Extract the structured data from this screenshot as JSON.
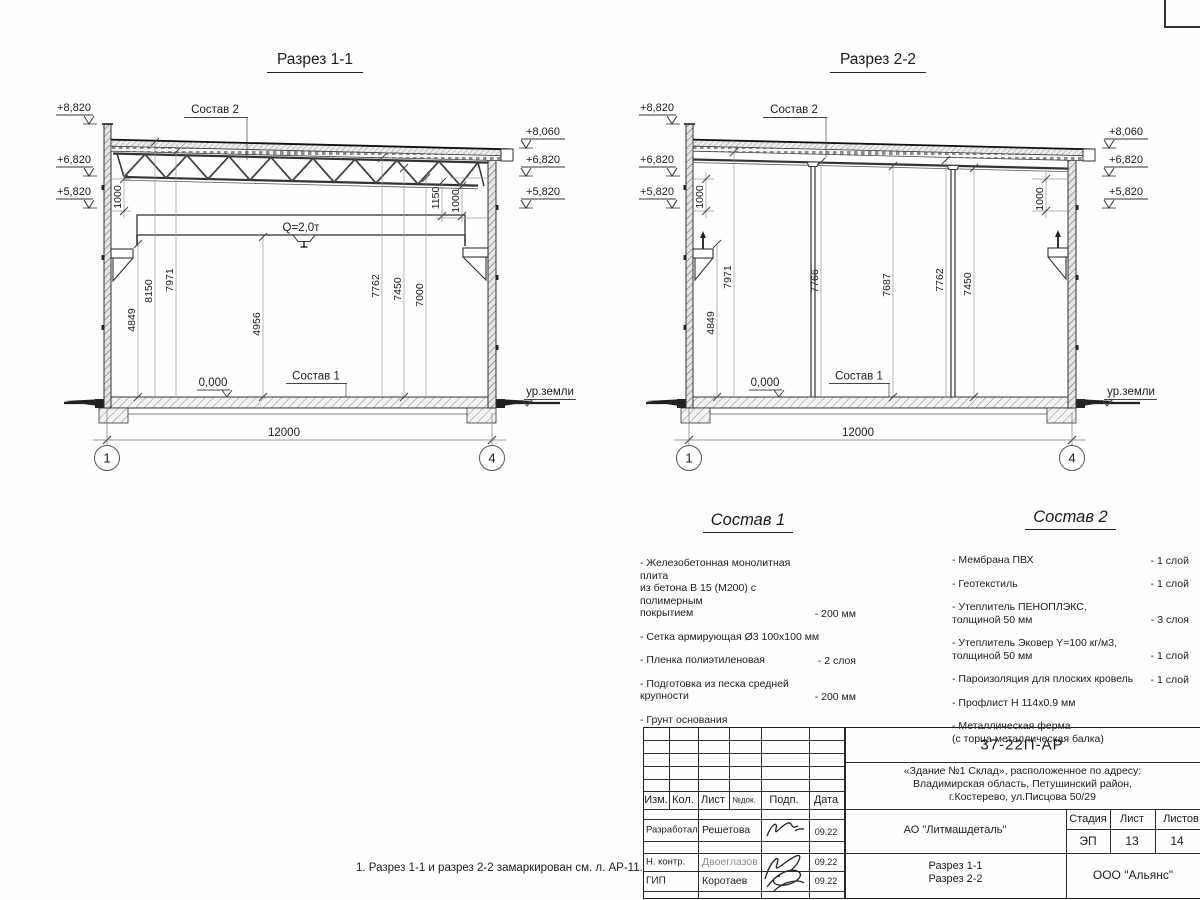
{
  "sheet": {
    "note": "1. Разрез 1-1 и разрез 2-2 замаркирован см. л. АР-11."
  },
  "section1": {
    "title": "Разрез 1-1",
    "labels": {
      "sostav2": "Состав 2",
      "sostav1": "Состав 1",
      "zero": "0,000",
      "ground": "ур.земли",
      "crane": "Q=2,0т"
    },
    "elevations_left": [
      "+8,820",
      "+6,820",
      "+5,820"
    ],
    "elevations_right": [
      "+8,060",
      "+6,820",
      "+5,820"
    ],
    "dims_vertical": [
      "4849",
      "8150",
      "7971",
      "4956",
      "7762",
      "7450",
      "7000"
    ],
    "dims_side": [
      "1000",
      "1150",
      "1000"
    ],
    "span": "12000",
    "axes": {
      "left": "1",
      "right": "4"
    }
  },
  "section2": {
    "title": "Разрез 2-2",
    "labels": {
      "sostav2": "Состав 2",
      "sostav1": "Состав 1",
      "zero": "0,000",
      "ground": "ур.земли"
    },
    "elevations_left": [
      "+8,820",
      "+6,820",
      "+5,820"
    ],
    "elevations_right": [
      "+8,060",
      "+6,820",
      "+5,820"
    ],
    "dims_vertical": [
      "4849",
      "7971",
      "7766",
      "7687",
      "7762",
      "7450"
    ],
    "dims_side": [
      "1000",
      "1000"
    ],
    "span": "12000",
    "axes": {
      "left": "1",
      "right": "4"
    }
  },
  "sostav1_block": {
    "title": "Состав 1",
    "items": [
      {
        "text": "- Железобетонная  монолитная плита\nиз бетона В 15 (М200) с полимерным\nпокрытием",
        "qty": "- 200 мм"
      },
      {
        "text": "- Сетка армирующая Ø3 100х100 мм"
      },
      {
        "text": "- Пленка полиэтиленовая",
        "qty": "-  2 слоя"
      },
      {
        "text": "- Подготовка из песка средней\n  крупности",
        "qty": "- 200 мм"
      },
      {
        "text": "- Грунт основания"
      }
    ]
  },
  "sostav2_block": {
    "title": "Состав 2",
    "items": [
      {
        "text": "- Мембрана ПВХ",
        "qty": "- 1 слой"
      },
      {
        "text": "- Геотекстиль",
        "qty": "- 1 слой"
      },
      {
        "text": "- Утеплитель ПЕНОПЛЭКС,\nтолщиной 50 мм",
        "qty": "- 3 слоя"
      },
      {
        "text": "- Утеплитель Эковер Y=100 кг/м3,\nтолщиной 50 мм",
        "qty": "- 1 слой"
      },
      {
        "text": "- Пароизоляция для плоских кровель",
        "qty": "- 1 слой"
      },
      {
        "text": "- Профлист Н 114х0.9 мм"
      },
      {
        "text": "- Металлическая ферма\n(с торца металлическая балка)"
      }
    ]
  },
  "titleblock": {
    "doc_number": "37-22П-АР",
    "object_address": "«Здание №1 Склад», расположенное по адресу:\nВладимирская область, Петушинский район,\nг.Костерево, ул.Писцова 50/29",
    "columns": [
      "Изм.",
      "Кол.",
      "Лист",
      "№док.",
      "Подп.",
      "Дата"
    ],
    "rows": [
      {
        "role": "Разработал",
        "name": "Решетова",
        "date": "09.22"
      },
      {
        "role": "Н. контр.",
        "name": "Двоеглазов",
        "date": "09.22"
      },
      {
        "role": "ГИП",
        "name": "Коротаев",
        "date": "09.22"
      }
    ],
    "company": "АО \"Литмашдеталь\"",
    "stage_label": "Стадия",
    "sheet_label": "Лист",
    "sheets_label": "Листов",
    "stage": "ЭП",
    "sheet_no": "13",
    "sheets_total": "14",
    "drawing_title": "Разрез 1-1\nРазрез 2-2",
    "org": "ООО \"Альянс\""
  }
}
